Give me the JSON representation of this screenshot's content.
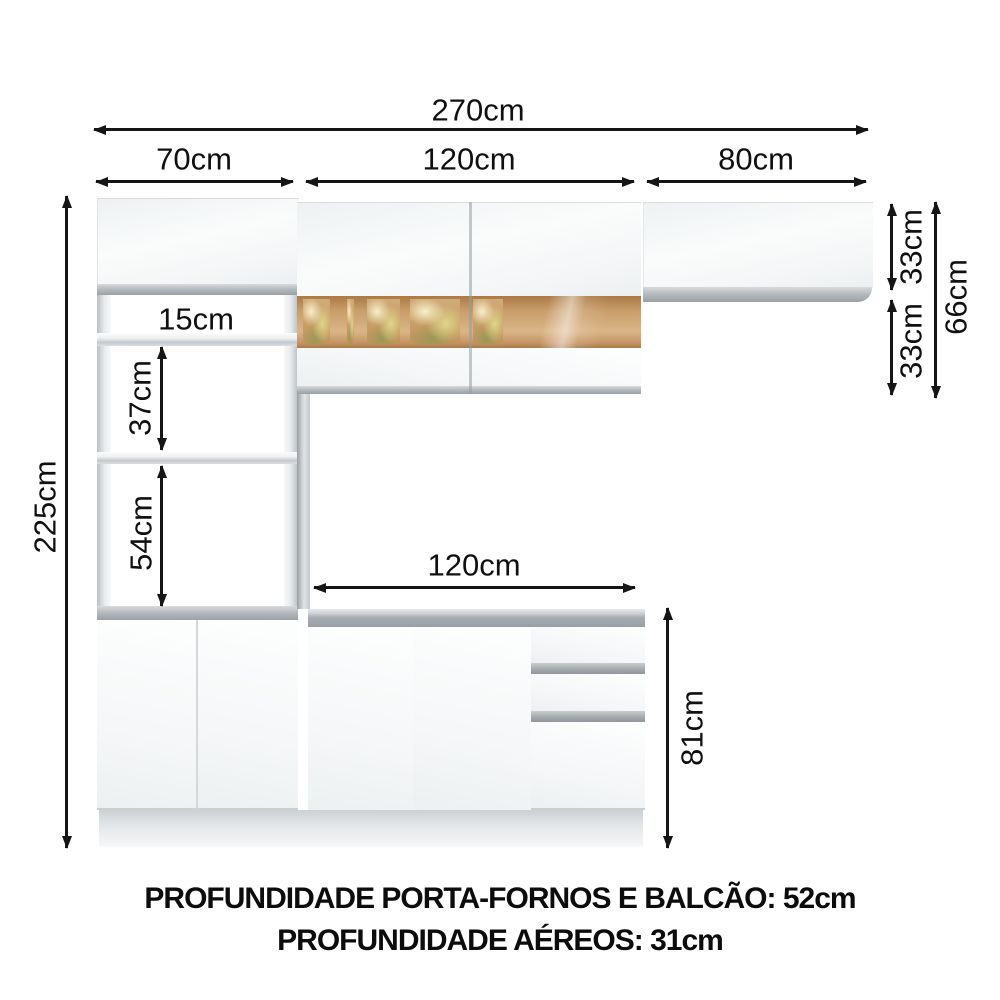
{
  "diagram": {
    "dimensions": {
      "total_width": "270cm",
      "tower_width": "70cm",
      "upper_middle_width": "120cm",
      "upper_right_width": "80cm",
      "total_height": "225cm",
      "niche_top_height": "15cm",
      "niche_middle_height": "37cm",
      "niche_bottom_height": "54cm",
      "counter_width": "120cm",
      "counter_height": "81cm",
      "upper_right_row_height": "33cm",
      "upper_lower_row_height": "33cm",
      "upper_total_height": "66cm"
    },
    "notes": {
      "depth_line1": "PROFUNDIDADE PORTA-FORNOS E BALCÃO: 52cm",
      "depth_line2": "PROFUNDIDADE AÉREOS: 31cm"
    },
    "colors": {
      "ink": "#151515",
      "cabinet_white": "#fbfcfd",
      "metal_gray": "#a6abb0",
      "glass_amber": "#c89a66",
      "foliage_yellow": "#ddd08d"
    }
  }
}
